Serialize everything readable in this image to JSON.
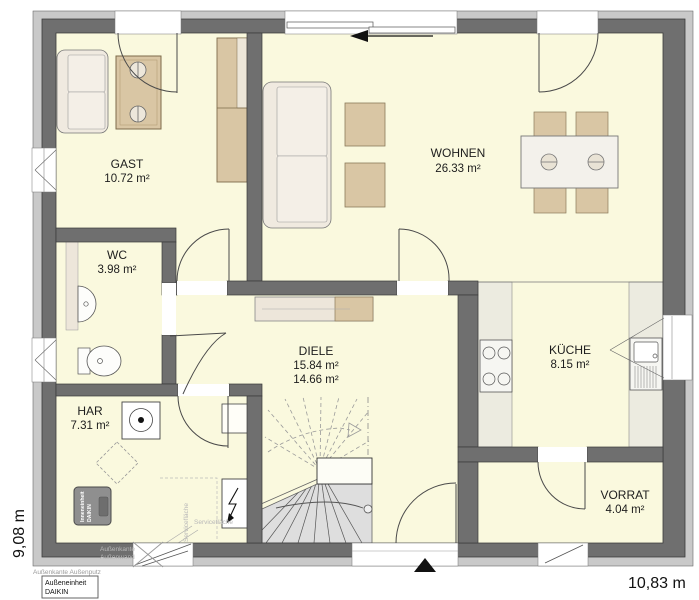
{
  "rooms": {
    "gast": {
      "name": "GAST",
      "area": "10.72 m²"
    },
    "wohnen": {
      "name": "WOHNEN",
      "area": "26.33 m²"
    },
    "wc": {
      "name": "WC",
      "area": "3.98 m²"
    },
    "diele": {
      "name": "DIELE",
      "area1": "15.84 m²",
      "area2": "14.66 m²"
    },
    "kueche": {
      "name": "KÜCHE",
      "area": "8.15 m²"
    },
    "har": {
      "name": "HAR",
      "area": "7.31 m²"
    },
    "vorrat": {
      "name": "VORRAT",
      "area": "4.04 m²"
    }
  },
  "dimensions": {
    "height_left": "9,08 m",
    "width_bottom": "10,83 m"
  },
  "annotations": {
    "indoor_unit_line1": "Inneneinheit",
    "indoor_unit_line2": "DAIKIN",
    "outdoor_unit_line1": "Außeneinheit",
    "outdoor_unit_line2": "DAIKIN",
    "edge_wall_line1": "Außenkante",
    "edge_wall_line2": "Außenwand",
    "edge_plaster": "Außenkante Außenputz",
    "service_area_vertical": "Servicefläche",
    "service_area_horizontal": "Servicefläche"
  },
  "colors": {
    "floor": "#FAF9DE",
    "wall": "#6F6F6F",
    "outer_band": "#C9C9C9",
    "furniture_tan": "#D9C6A4",
    "furniture_light": "#F0EAE0",
    "counter": "#ECEBE0",
    "stairs": "#DEDEDE",
    "unit_gray": "#8F8F8F"
  }
}
